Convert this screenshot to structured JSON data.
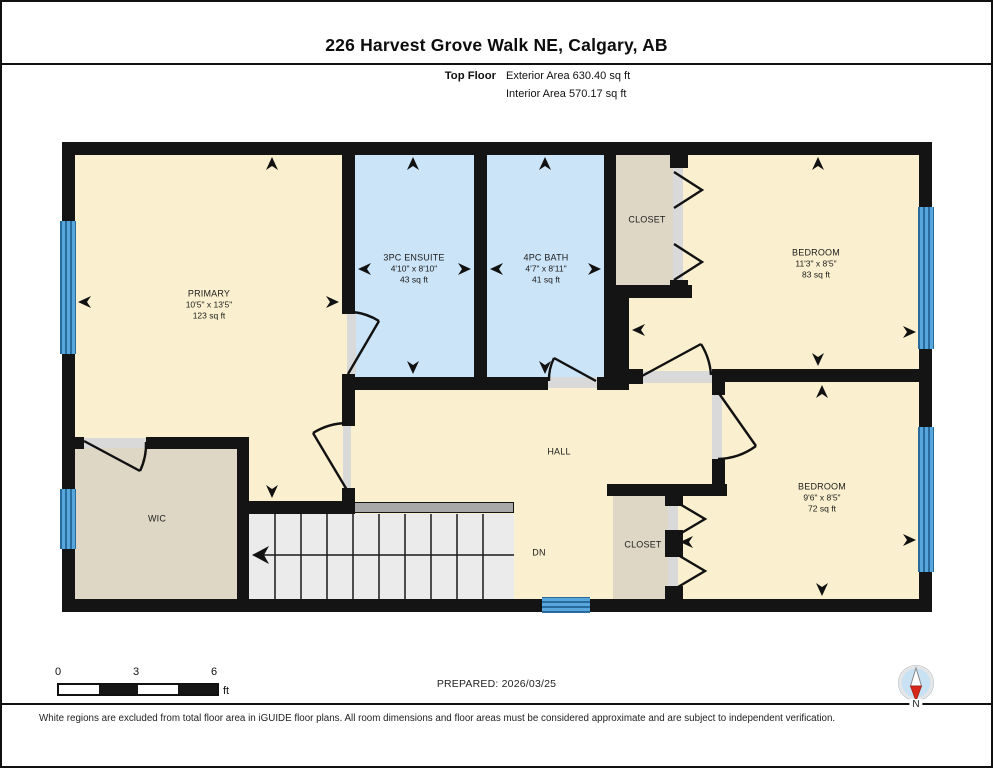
{
  "header": {
    "title": "226 Harvest Grove Walk NE, Calgary, AB",
    "floor_label": "Top Floor",
    "exterior_area": "Exterior Area 630.40 sq ft",
    "interior_area": "Interior Area 570.17 sq ft"
  },
  "rooms": {
    "primary": {
      "name": "PRIMARY",
      "dims": "10'5\" x 13'5\"",
      "area": "123 sq ft"
    },
    "ensuite": {
      "name": "3PC ENSUITE",
      "dims": "4'10\" x 8'10\"",
      "area": "43 sq ft"
    },
    "bath": {
      "name": "4PC BATH",
      "dims": "4'7\" x 8'11\"",
      "area": "41 sq ft"
    },
    "bedroom_top": {
      "name": "BEDROOM",
      "dims": "11'3\" x 8'5\"",
      "area": "83 sq ft"
    },
    "bedroom_bottom": {
      "name": "BEDROOM",
      "dims": "9'6\" x 8'5\"",
      "area": "72 sq ft"
    },
    "closet_top": {
      "name": "CLOSET"
    },
    "closet_bottom": {
      "name": "CLOSET"
    },
    "wic": {
      "name": "WIC"
    },
    "hall": {
      "name": "HALL"
    }
  },
  "stairs": {
    "label": "DN"
  },
  "scale_bar": {
    "labels": [
      "0",
      "3",
      "6"
    ],
    "unit": "ft"
  },
  "footer": {
    "prepared": "PREPARED: 2026/03/25",
    "compass_label": "N",
    "disclaimer": "White regions are excluded from total floor area in iGUIDE floor plans. All room dimensions and floor areas must be considered approximate and are subject to independent verification."
  },
  "colors": {
    "room_fill": "#FAF0CF",
    "wet_room_fill": "#CBE4F7",
    "closet_fill": "#DED7C5",
    "wall": "#141414",
    "window": "#57A7DC",
    "window_stripe": "#2A6B9E",
    "stair_fill": "#EBEBEB",
    "door_jamb": "#D9D9D9",
    "compass_blue": "#C8E1F3",
    "compass_red": "#D62718"
  }
}
